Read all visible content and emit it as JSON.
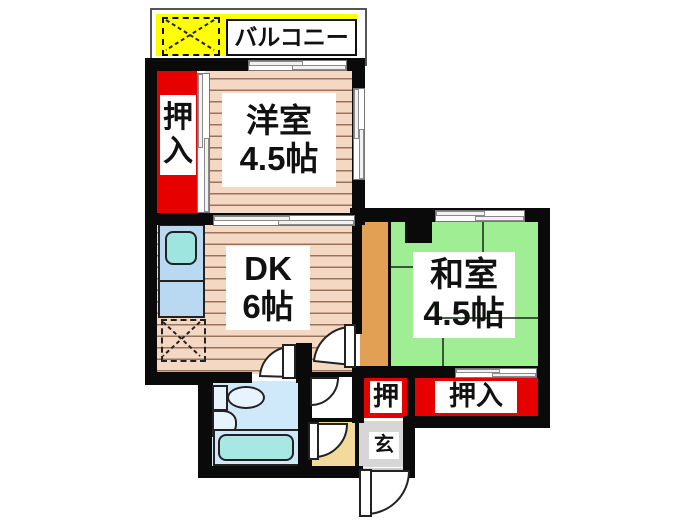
{
  "balcony": {
    "label": "バルコニー"
  },
  "closet_left": {
    "label": "押入"
  },
  "rooms": {
    "western": {
      "name": "洋室",
      "size": "4.5帖"
    },
    "dk": {
      "name": "DK",
      "size": "6帖"
    },
    "japanese": {
      "name": "和室",
      "size": "4.5帖"
    }
  },
  "closet_small": {
    "label": "押"
  },
  "closet_right": {
    "label": "押入"
  },
  "entrance": {
    "label": "玄"
  },
  "colors": {
    "wall": "#0a0a0a",
    "closet_red": "#e60000",
    "balcony_yellow": "#ffff00",
    "wood_floor": "#f5d8c4",
    "wood_stripe": "#9a735c",
    "tatami_green": "#9fee94",
    "corridor_orange": "#e2a055",
    "genkan_gray": "#d6d6d6",
    "vestibule_cream": "#f2da9c",
    "bathroom_blue": "#cfe8fa",
    "bathtub_cyan": "#a8e8e4",
    "kitchen_blue": "#b9d9f2",
    "sink_teal": "#9fe5df"
  }
}
